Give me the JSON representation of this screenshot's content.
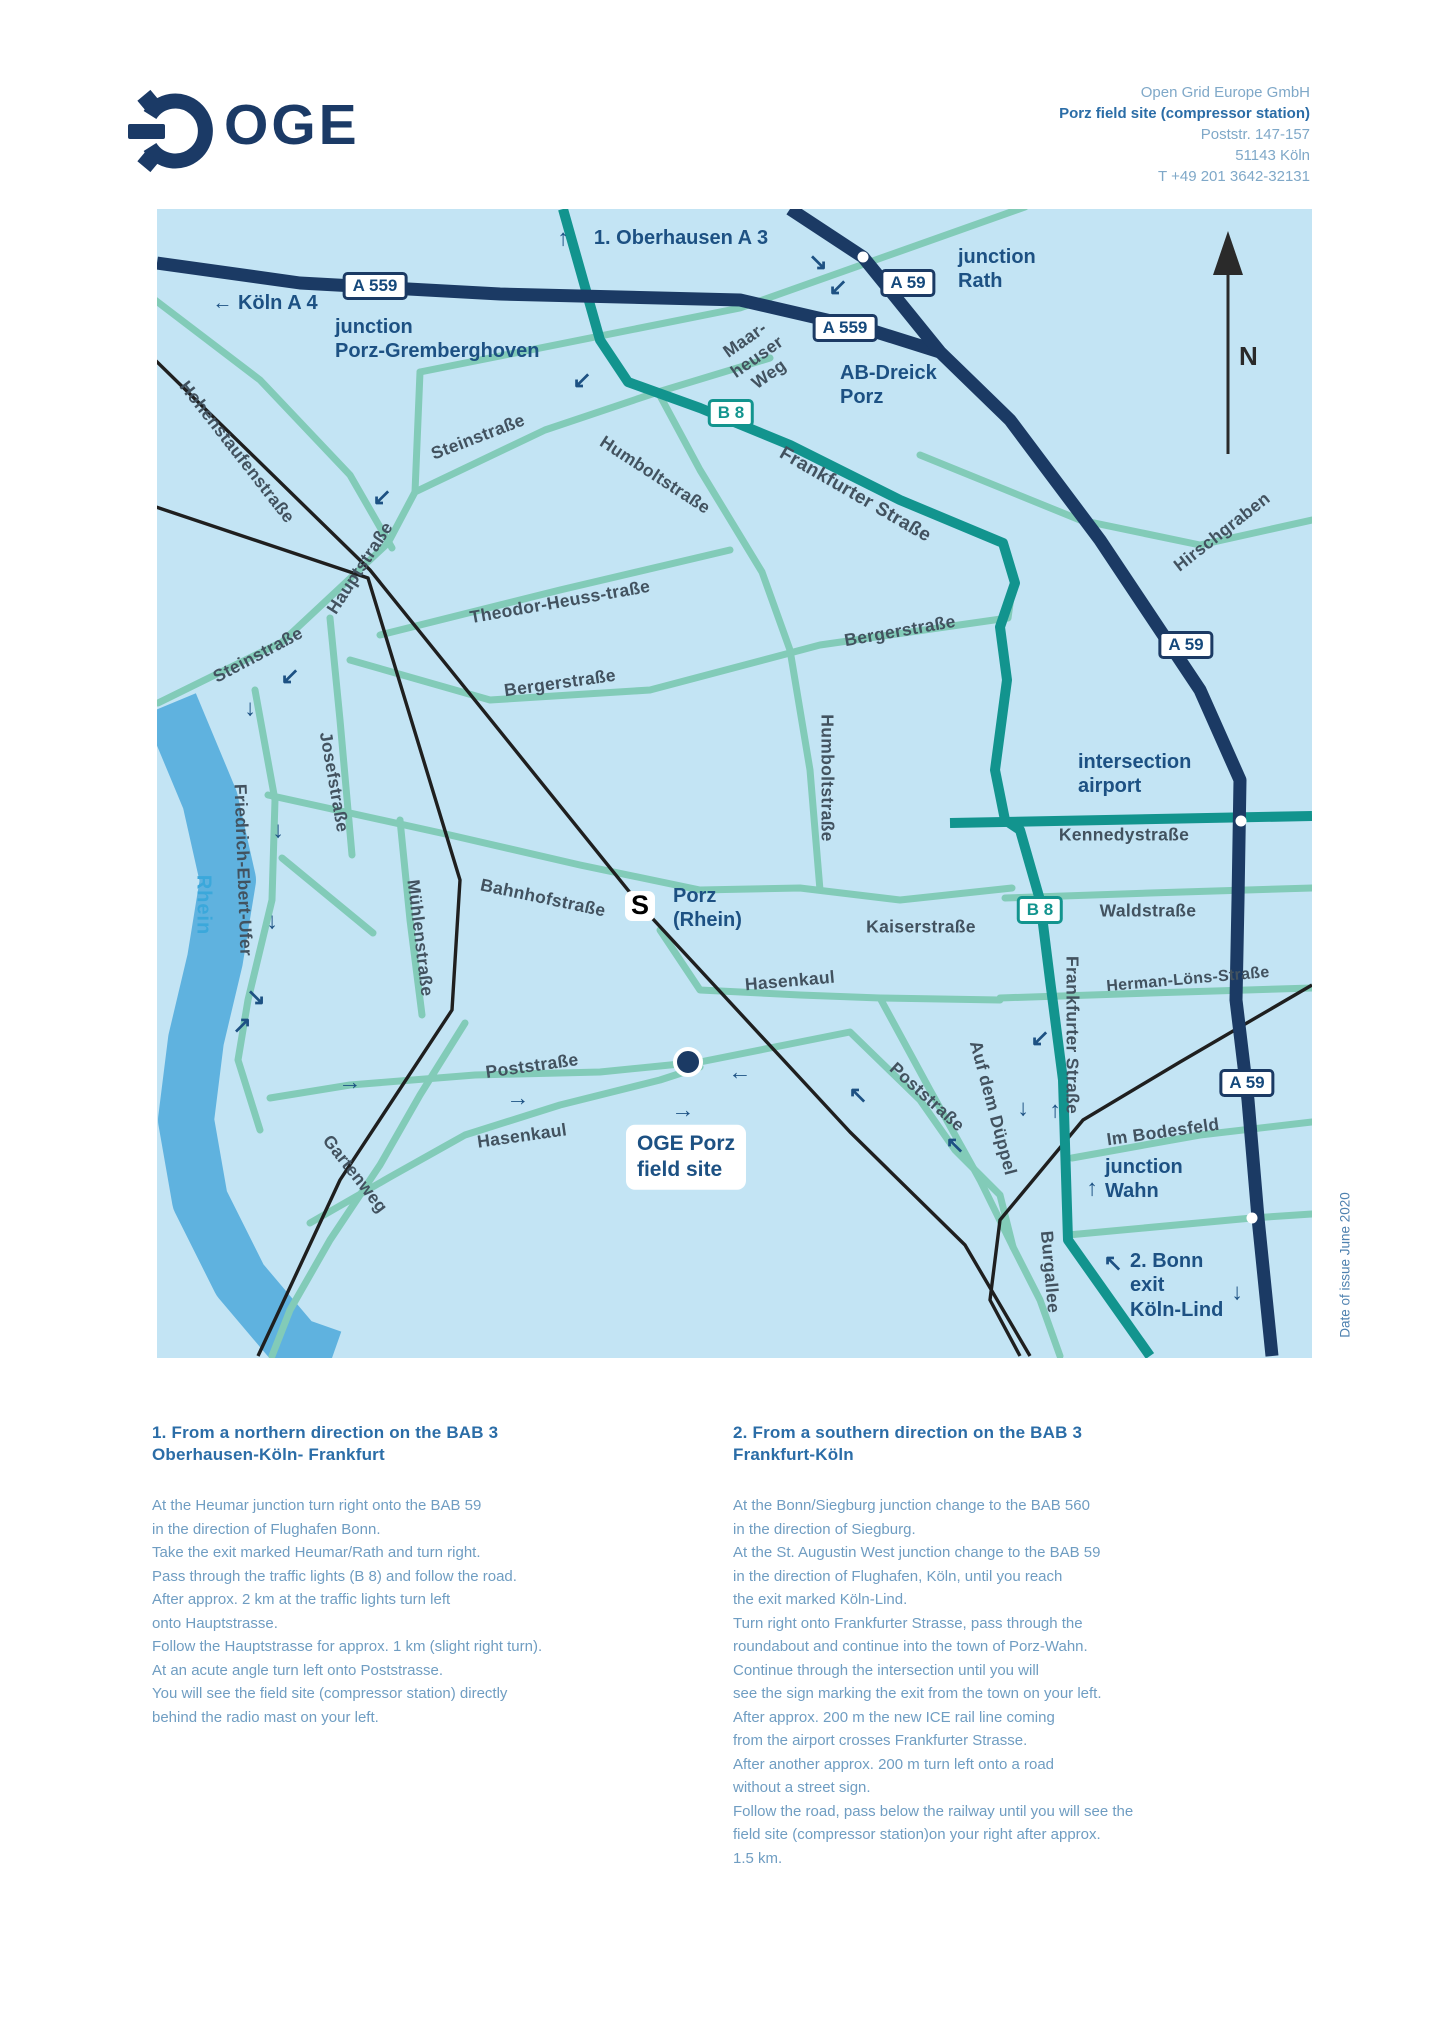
{
  "header": {
    "logo_text": "OGE",
    "address": {
      "company": "Open Grid Europe GmbH",
      "site": "Porz field site (compressor station)",
      "street": "Poststr. 147-157",
      "city": "51143 Köln",
      "phone": "T +49 201 3642-32131"
    }
  },
  "map": {
    "north_label": "N",
    "station_icon": "S",
    "river_label": "Rhein",
    "site_label": "OGE Porz\nfield site",
    "badges": [
      {
        "text": "A 559"
      },
      {
        "text": "A 559"
      },
      {
        "text": "A 59"
      },
      {
        "text": "A 59"
      },
      {
        "text": "A 59"
      },
      {
        "text": "B 8"
      },
      {
        "text": "B 8"
      }
    ],
    "direction_labels": [
      {
        "text": "1. Oberhausen A 3"
      },
      {
        "text": "← Köln A 4"
      },
      {
        "text": "junction\nPorz-Gremberghoven"
      },
      {
        "text": "junction\nRath"
      },
      {
        "text": "AB-Dreick\nPorz"
      },
      {
        "text": "intersection\nairport"
      },
      {
        "text": "junction\nWahn"
      },
      {
        "text": "2. Bonn\nexit\nKöln-Lind"
      },
      {
        "text": "Porz\n(Rhein)"
      }
    ],
    "street_labels": [
      {
        "text": "Hohenstaufenstraße"
      },
      {
        "text": "Steinstraße"
      },
      {
        "text": "Hauptstraße"
      },
      {
        "text": "Steinstraße"
      },
      {
        "text": "Humboltstraße"
      },
      {
        "text": "Maar-\nheuser\nWeg"
      },
      {
        "text": "Frankfurter Straße"
      },
      {
        "text": "Hirschgraben"
      },
      {
        "text": "Theodor-Heuss-traße"
      },
      {
        "text": "Bergerstraße"
      },
      {
        "text": "Bergerstraße"
      },
      {
        "text": "Humboltstraße"
      },
      {
        "text": "Kennedystraße"
      },
      {
        "text": "Waldstraße"
      },
      {
        "text": "Herman-Löns-Straße"
      },
      {
        "text": "Frankfurter Straße"
      },
      {
        "text": "Kaiserstraße"
      },
      {
        "text": "Hasenkaul"
      },
      {
        "text": "Hasenkaul"
      },
      {
        "text": "Poststraße"
      },
      {
        "text": "Poststraße"
      },
      {
        "text": "Auf dem Düppel"
      },
      {
        "text": "Gartenweg"
      },
      {
        "text": "Mühlenstraße"
      },
      {
        "text": "Josefstraße"
      },
      {
        "text": "Friedrich-Ebert-Ufer"
      },
      {
        "text": "Bahnhofstraße"
      },
      {
        "text": "Im Bodesfeld"
      },
      {
        "text": "Burgallee"
      }
    ],
    "arrows": [
      {
        "glyph": "↑"
      },
      {
        "glyph": "↘"
      },
      {
        "glyph": "↙"
      },
      {
        "glyph": "↙"
      },
      {
        "glyph": "↙"
      },
      {
        "glyph": "↙"
      },
      {
        "glyph": "↓"
      },
      {
        "glyph": "↓"
      },
      {
        "glyph": "↓"
      },
      {
        "glyph": "↘"
      },
      {
        "glyph": "↗"
      },
      {
        "glyph": "→"
      },
      {
        "glyph": "→"
      },
      {
        "glyph": "→"
      },
      {
        "glyph": "←"
      },
      {
        "glyph": "↖"
      },
      {
        "glyph": "↙"
      },
      {
        "glyph": "↓"
      },
      {
        "glyph": "↑"
      },
      {
        "glyph": "↖"
      },
      {
        "glyph": "↑"
      },
      {
        "glyph": "↖"
      },
      {
        "glyph": "↓"
      }
    ]
  },
  "directions": {
    "sections": [
      {
        "title": "1. From a northern direction on the BAB 3\nOberhausen-Köln- Frankfurt",
        "body": "At the Heumar junction turn right onto the BAB 59\nin the direction of Flughafen Bonn.\nTake the exit marked Heumar/Rath and turn right.\nPass through the traffic lights (B 8) and follow the road.\nAfter approx. 2 km at the traffic lights turn left\nonto Hauptstrasse.\nFollow the Hauptstrasse for approx. 1 km (slight right turn).\nAt an acute angle turn left onto Poststrasse.\nYou will see the field site (compressor station) directly\nbehind the radio mast on your left."
      },
      {
        "title": "2. From a southern direction on the BAB 3\nFrankfurt-Köln",
        "body": "At the Bonn/Siegburg junction change to the BAB 560\nin the direction of Siegburg.\nAt the St. Augustin West junction change to the BAB 59\nin the direction of Flughafen, Köln, until you reach\nthe exit marked Köln-Lind.\nTurn right onto Frankfurter Strasse, pass through the\nroundabout and continue into the town of Porz-Wahn.\nContinue through the intersection until you will\nsee the sign marking the exit from the town on your left.\nAfter approx. 200 m the new ICE rail line coming\nfrom the airport crosses Frankfurter Strasse.\nAfter another approx. 200 m turn left onto a road\nwithout a street sign.\nFollow the road, pass below the railway until you will see the\nfield site (compressor station)on your right after approx.\n1.5 km."
      }
    ]
  },
  "footer_note": "Date of issue June 2020"
}
